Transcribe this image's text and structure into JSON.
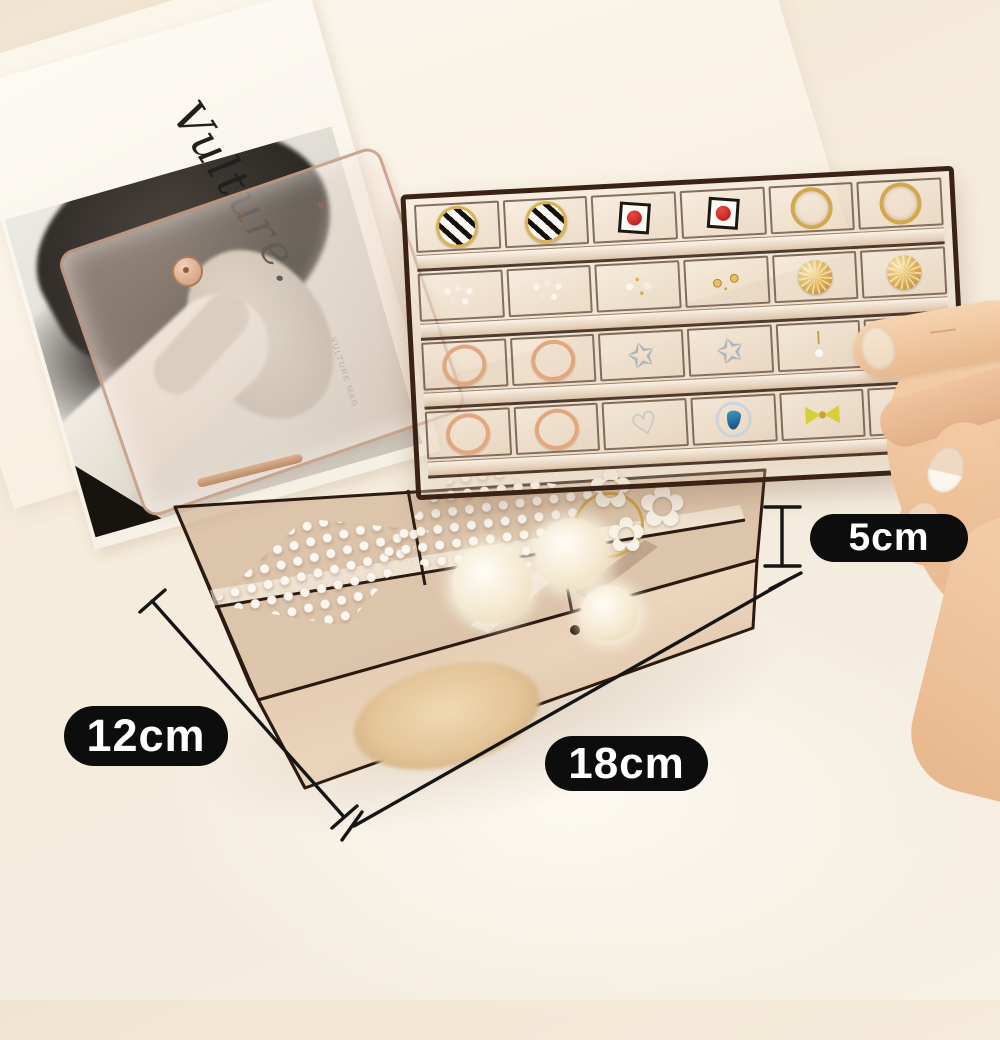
{
  "product_photo": {
    "magazine": {
      "masthead": "Vulture.",
      "side_caption": "VULTURE MAG"
    },
    "measurements": {
      "height": "5cm",
      "width": "12cm",
      "length": "18cm"
    },
    "tray": {
      "rows": 4,
      "cols": 6,
      "cells": [
        "striped-hoop",
        "striped-hoop",
        "red-square-stud",
        "red-square-stud",
        "gold-hoop",
        "gold-hoop",
        "pearl-cluster",
        "pearl-cluster",
        "pearl-studs",
        "gold-studs",
        "gold-wire-ball",
        "gold-wire-ball",
        "rose-gold-hoop",
        "rose-gold-hoop",
        "silver-star",
        "silver-star",
        "pearl-drop",
        "gold-flower",
        "rose-gold-hoop",
        "rose-gold-hoop",
        "silver-heart",
        "blue-gem",
        "yellow-bow",
        "green-bow"
      ]
    },
    "box_items": [
      "pearl-hair-clip",
      "pearl-hair-clip",
      "gold-wire-hoop",
      "white-flower-hair-ties",
      "fur-pompoms",
      "beige-scrunchie"
    ],
    "colors": {
      "background": "#f4ebdb",
      "acrylic_tint": "#c9a178",
      "frame_dark": "#3a2315",
      "badge_bg": "#0d0d0d",
      "badge_text": "#ffffff",
      "gold": "#d2a84e",
      "rose_gold": "#e2a77f",
      "silver": "#b9c0cc",
      "red": "#d42020",
      "blue_gem": "#1f6fae",
      "green": "#58a43c",
      "yellow": "#d6cf3a",
      "pearl": "#f7f3ea",
      "skin": "#f0c6a2"
    }
  }
}
